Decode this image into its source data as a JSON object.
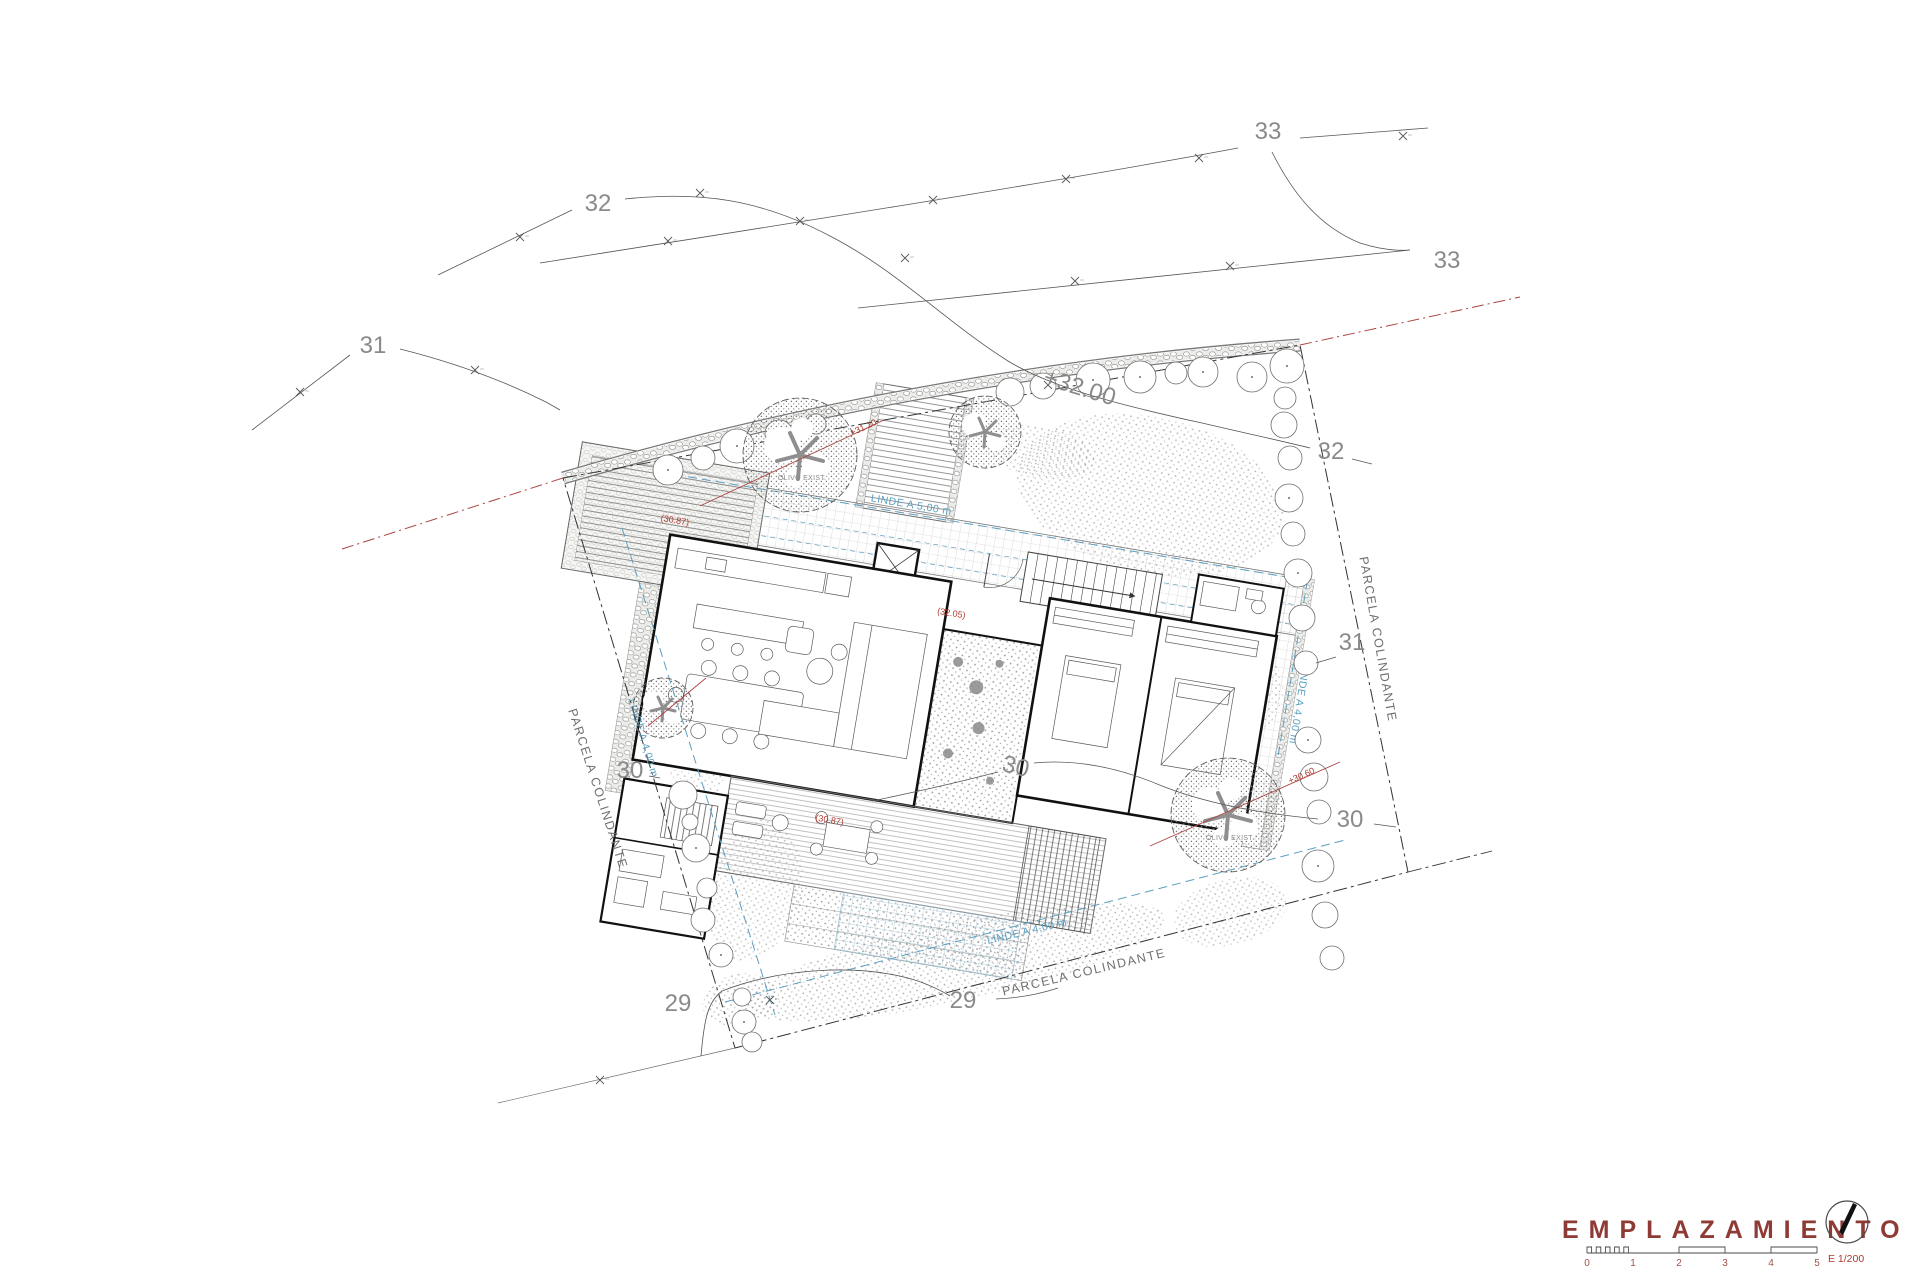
{
  "contour_labels": {
    "c33_top": "33",
    "c33_right": "33",
    "c32_left": "32",
    "c32_right": "32",
    "c31_left": "31",
    "c31_right": "31",
    "c30_left": "30",
    "c30_center": "30",
    "c30_right": "30",
    "c29_left": "29",
    "c29_bottom": "29"
  },
  "parcel_labels": {
    "left": "PARCELA COLINDANTE",
    "right": "PARCELA COLINDANTE",
    "bottom": "PARCELA COLINDANTE"
  },
  "setback_labels": {
    "top": "LINDE A 5,00 m",
    "left": "LINDE A 4,00 m",
    "right": "LINDE A 4,00 m",
    "bottom": "LINDE A 4,00 m"
  },
  "elevation_labels": {
    "contour32": "+32.00",
    "entrance": "(32.05)",
    "driveway": "(30.87)",
    "deck": "(30.87)",
    "olive_top": "+31.10",
    "olive_bottom": "+30.60"
  },
  "tree_labels": {
    "olive_top": "OLIVO EXIST.",
    "olive_bottom": "OLIVO EXIST."
  },
  "titleblock": {
    "title": "EMPLAZAMIENTO",
    "scale_label": "E 1/200",
    "scale_ticks": [
      "0",
      "1",
      "2",
      "3",
      "4",
      "5"
    ]
  },
  "colors": {
    "title_red": "#8f3b35",
    "annotation_red": "#b03a2e",
    "setback_blue": "#5b9fc0",
    "contour_gray": "#555555",
    "label_gray": "#8a8a8a"
  }
}
